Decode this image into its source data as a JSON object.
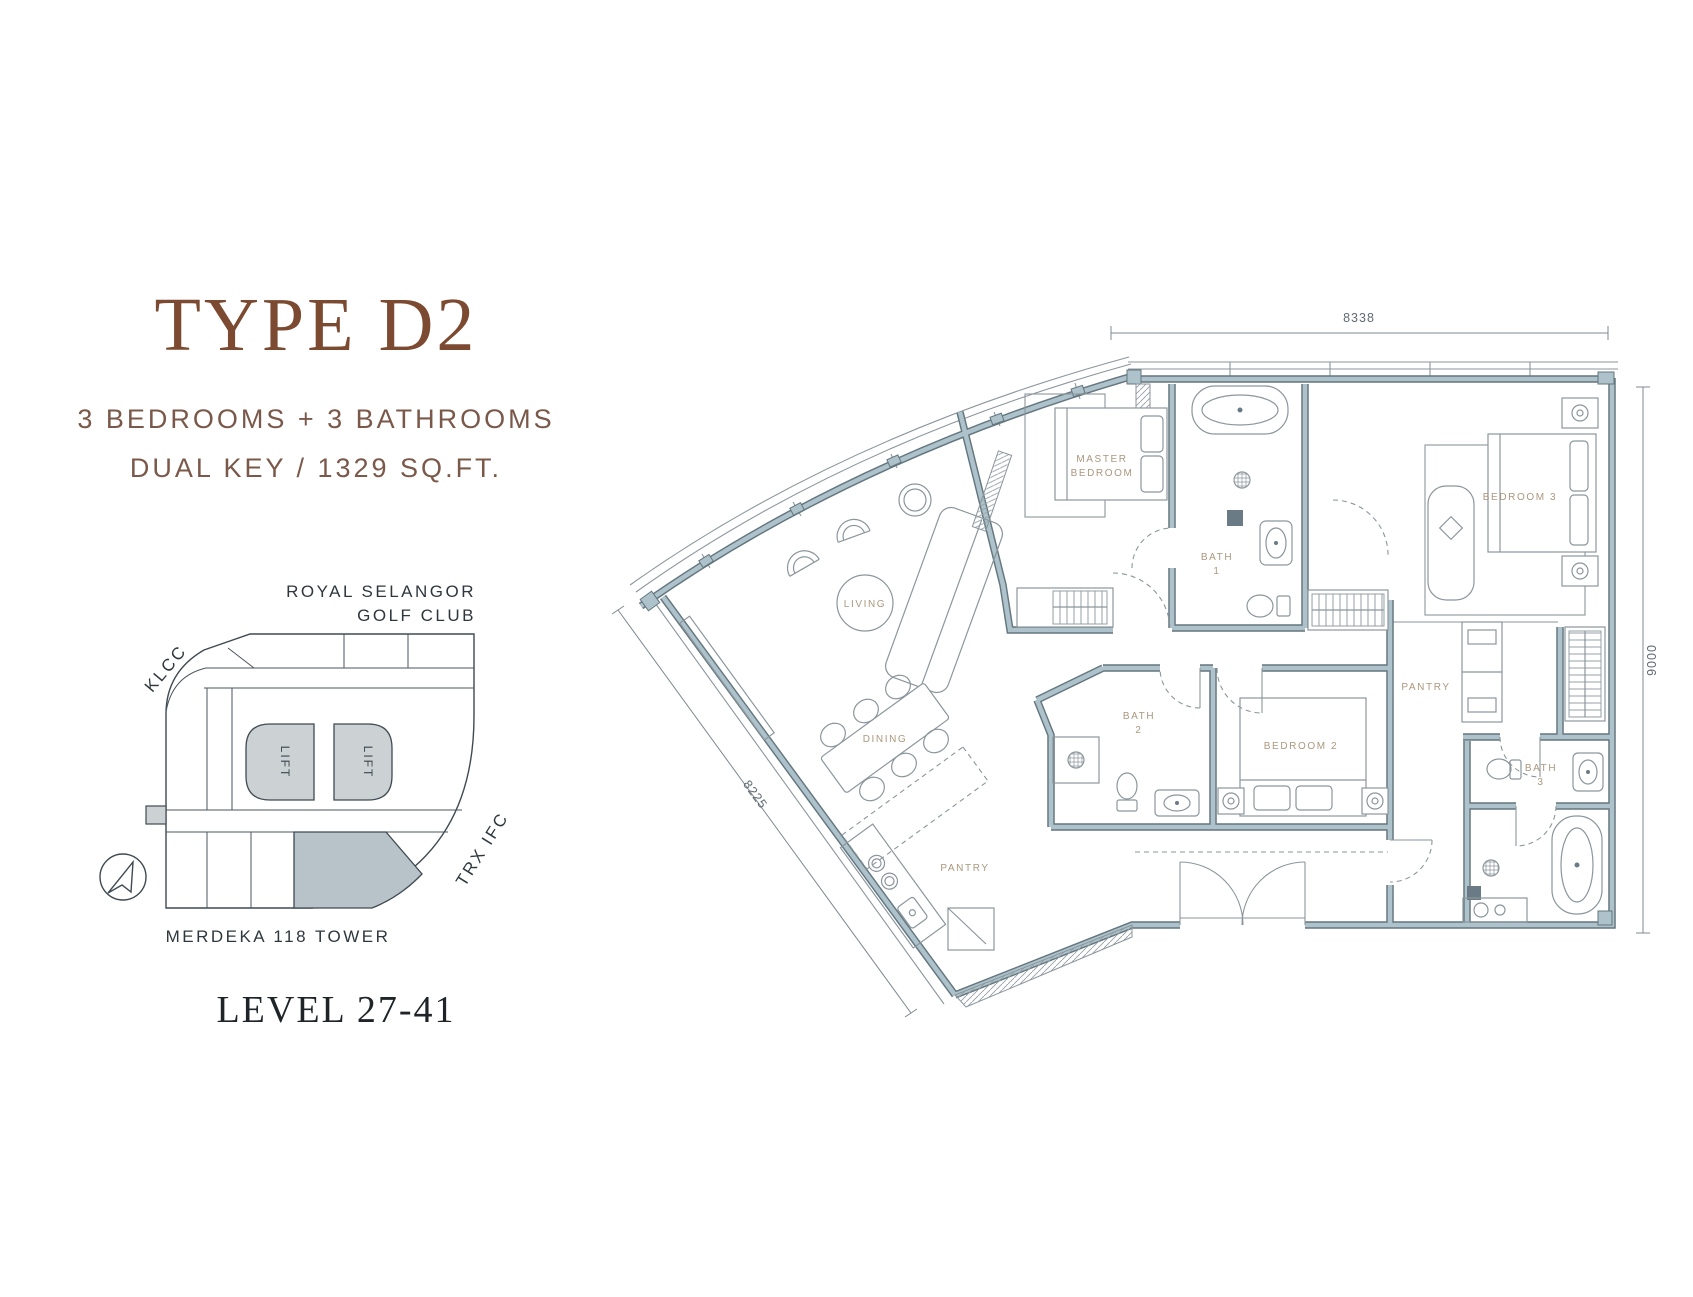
{
  "header": {
    "title": "TYPE D2",
    "subtitle_line1": "3 BEDROOMS + 3 BATHROOMS",
    "subtitle_line2": "DUAL KEY / 1329 SQ.FT."
  },
  "key_plan": {
    "landmark_top_line1": "ROYAL SELANGOR",
    "landmark_top_line2": "GOLF CLUB",
    "landmark_left": "KLCC",
    "landmark_right": "TRX IFC",
    "landmark_bottom": "MERDEKA 118 TOWER",
    "lift_label": "LIFT",
    "level_label": "LEVEL 27-41",
    "colors": {
      "highlight": "#b7c3c9",
      "lift_fill": "#ccd1d4",
      "line": "#3f4a52"
    }
  },
  "floor_plan": {
    "dimensions": {
      "top": "8338",
      "right": "9000",
      "left": "8225"
    },
    "rooms": {
      "master_line1": "MASTER",
      "master_line2": "BEDROOM",
      "bath1_line1": "BATH",
      "bath1_line2": "1",
      "bedroom3": "BEDROOM 3",
      "living": "LIVING",
      "dining": "DINING",
      "bath2_line1": "BATH",
      "bath2_line2": "2",
      "bedroom2": "BEDROOM 2",
      "pantry_kitchen": "PANTRY",
      "pantry_studio": "PANTRY",
      "bath3_line1": "BATH",
      "bath3_line2": "3"
    },
    "colors": {
      "wall_fill": "#adc2ca",
      "wall_edge": "#64767f",
      "line": "#8b969c",
      "label": "#ab977e",
      "dimension": "#5f6a72"
    }
  }
}
